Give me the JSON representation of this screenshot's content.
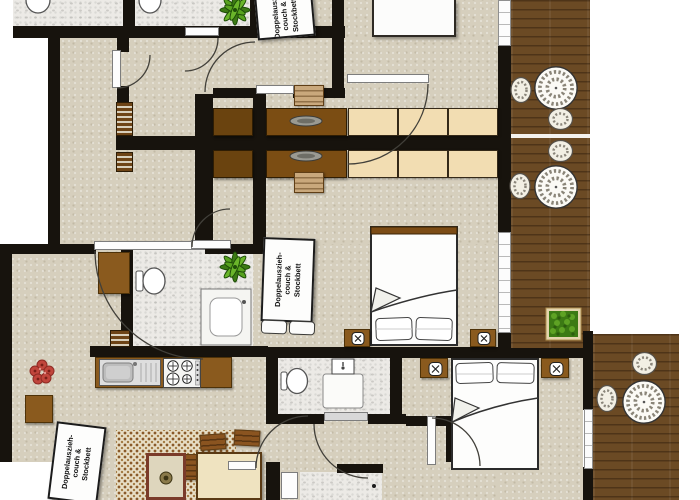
{
  "floorplan": {
    "title": "apartment-floor-plan",
    "sofa_label": {
      "full": "Doppelauszieh-couch & Stockbett",
      "line1": "Doppelauszieh-",
      "line2": "couch &",
      "line3": "Stockbett"
    },
    "colors": {
      "floor_beige": "#d6cfbd",
      "wall_black": "#17130d",
      "deck_brown": "#6b4a24",
      "bathroom_marble": "#eceae6",
      "furniture_wood": "#8a5a1e",
      "dining_table_wood": "#6a430f",
      "wardrobe_cream": "#f2ddb2",
      "bed_white": "#fcfcfb",
      "plant_green": "#4f9c1d",
      "flower_red": "#c0453c",
      "rug_cream": "#e7dec5"
    },
    "inventory": {
      "sofa_beds_labeled": 3,
      "double_beds": 3,
      "balcony_decks": 2,
      "deck_round_tables": 3,
      "wicker_chairs": 7,
      "toilets": 4,
      "bathrooms": 5,
      "dining_tables": 4,
      "wardrobe_units": 6,
      "nightstands_with_lamps": 4,
      "kitchen_sink": 1,
      "stove": 1,
      "potted_plants": 3,
      "planter_boxes": 1
    },
    "icon_names": [
      "toilet-icon",
      "sink-icon",
      "stove-icon",
      "double-bed-icon",
      "sofa-bed-icon",
      "round-table-icon",
      "wicker-chair-icon",
      "dining-chair-icon",
      "wardrobe-icon",
      "nightstand-lamp-icon",
      "potted-plant-icon",
      "flower-icon",
      "planter-box-icon",
      "rug-icon",
      "coffee-table-icon",
      "door-swing-icon",
      "window-icon"
    ]
  }
}
